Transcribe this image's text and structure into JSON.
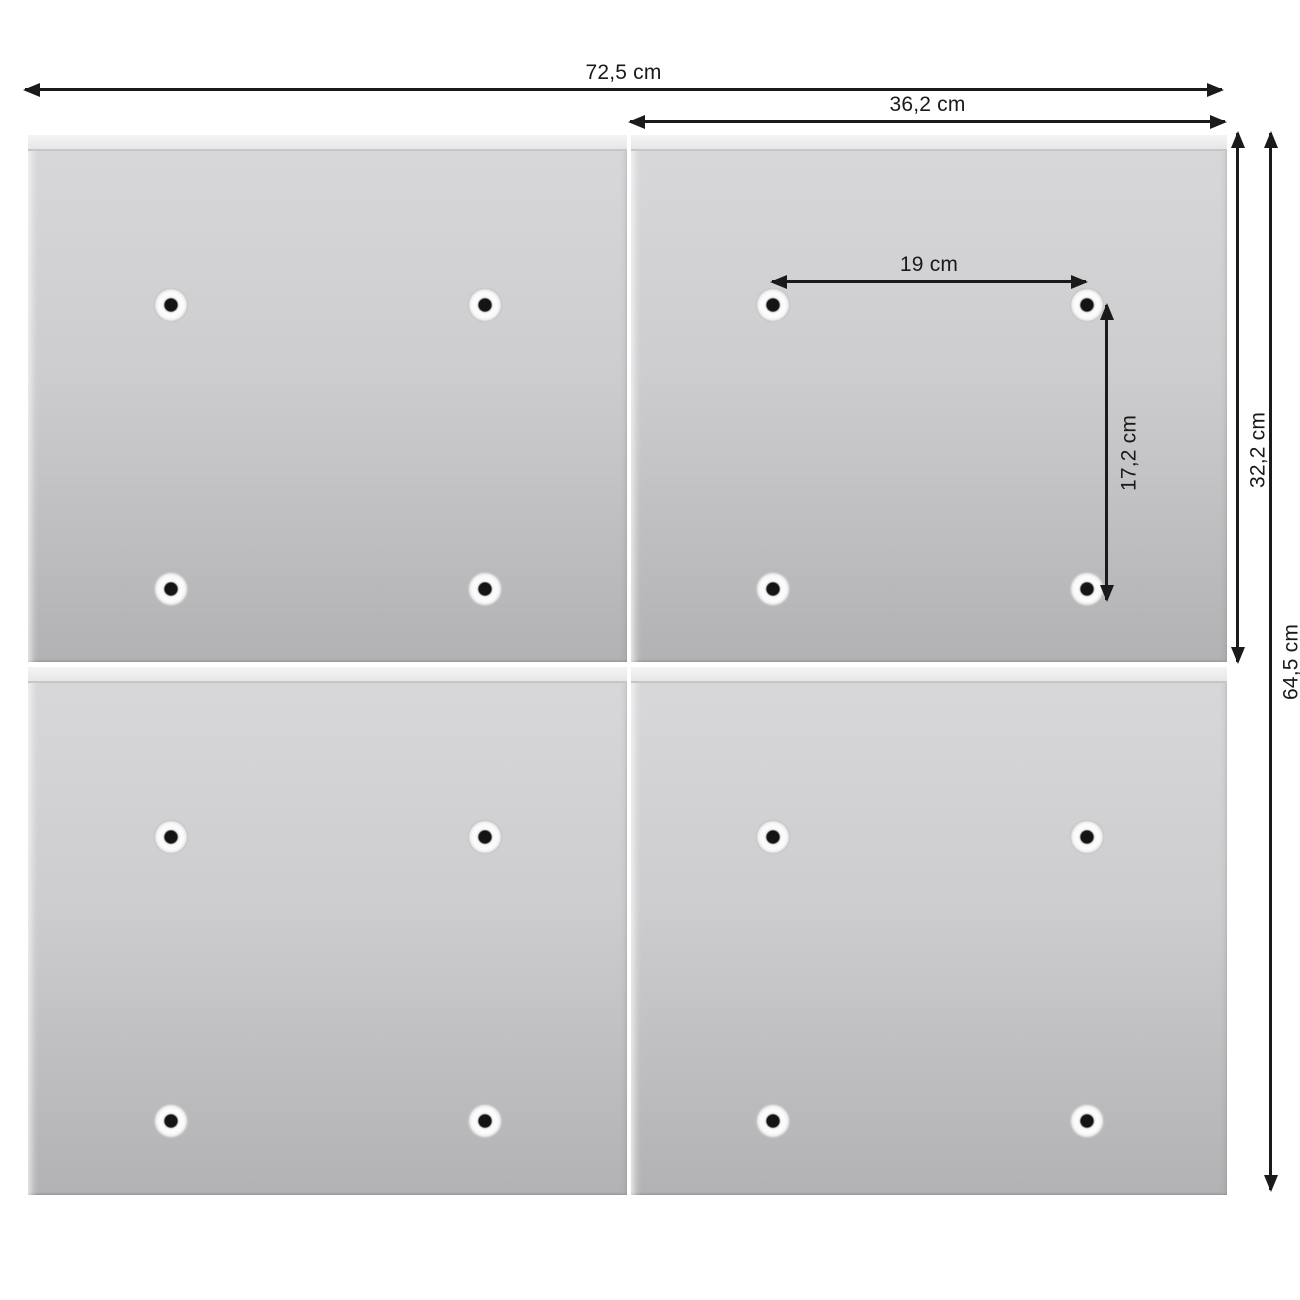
{
  "diagram": {
    "title": "panel-dimension-diagram",
    "labels": {
      "total_width": "72,5 cm",
      "panel_width": "36,2 cm",
      "hole_spacing_horizontal": "19 cm",
      "hole_spacing_vertical": "17,2 cm",
      "panel_height": "32,2 cm",
      "total_height": "64,5 cm"
    },
    "panels": {
      "count": 4,
      "rows": 2,
      "columns": 2,
      "holes_per_panel": 4
    },
    "colors": {
      "background": "#ffffff",
      "panel_light": "#d8d8da",
      "panel_dark": "#b2b2b4",
      "panel_bevel": "#efefef",
      "dimension_line": "#1a1a1a",
      "hole_center": "#141414",
      "hole_dimple": "#fbfbfb"
    }
  }
}
